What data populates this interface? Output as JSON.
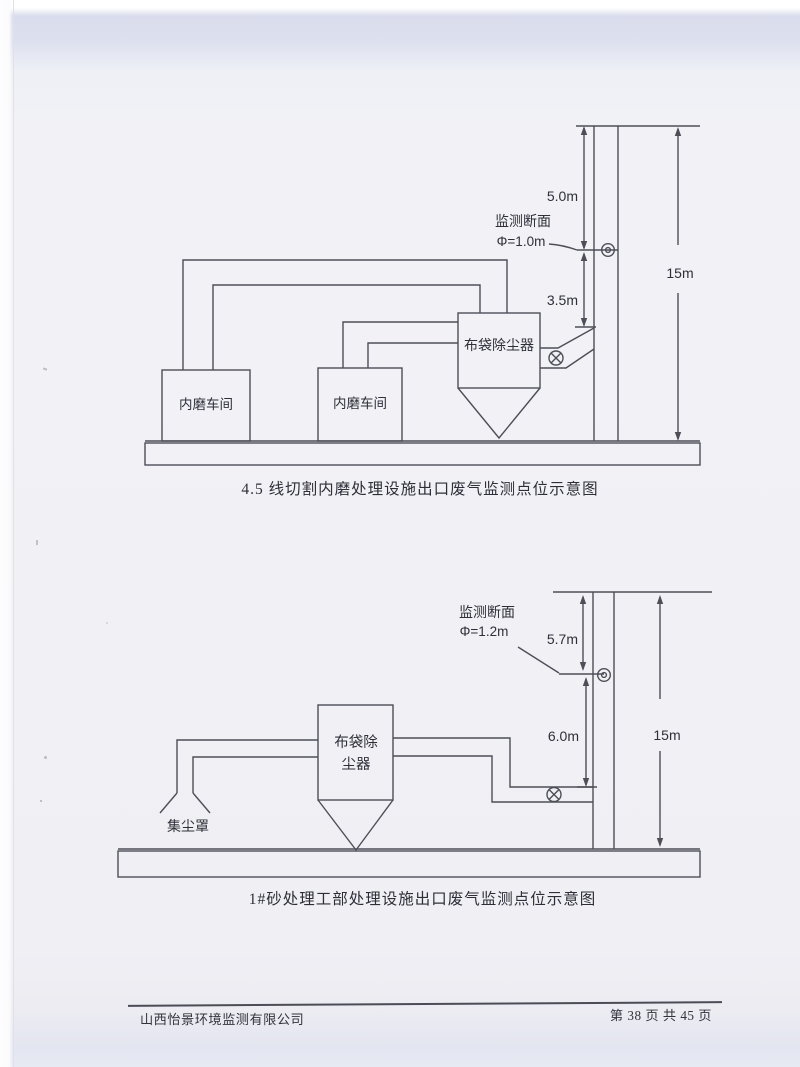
{
  "diagram_top": {
    "caption": "4.5 线切割内磨处理设施出口废气监测点位示意图",
    "workshop1_label": "内磨车间",
    "workshop2_label": "内磨车间",
    "dust_collector_label": "布袋除尘器",
    "monitor_section_label": "监测断面",
    "monitor_diameter_label": "Φ=1.0m",
    "dim_above_port": "5.0m",
    "dim_below_port": "3.5m",
    "stack_height": "15m"
  },
  "diagram_bottom": {
    "caption": "1#砂处理工部处理设施出口废气监测点位示意图",
    "dust_collector_label_line1": "布袋除",
    "dust_collector_label_line2": "尘器",
    "hood_label": "集尘罩",
    "monitor_section_label": "监测断面",
    "monitor_diameter_label": "Φ=1.2m",
    "dim_above_port": "5.7m",
    "dim_below_port": "6.0m",
    "stack_height": "15m"
  },
  "footer": {
    "company": "山西怡景环境监测有限公司",
    "page_info": "第 38 页 共 45 页"
  },
  "colors": {
    "line": "#4e4e58",
    "text": "#2f2f3a",
    "paper": "#f1f1f5"
  }
}
